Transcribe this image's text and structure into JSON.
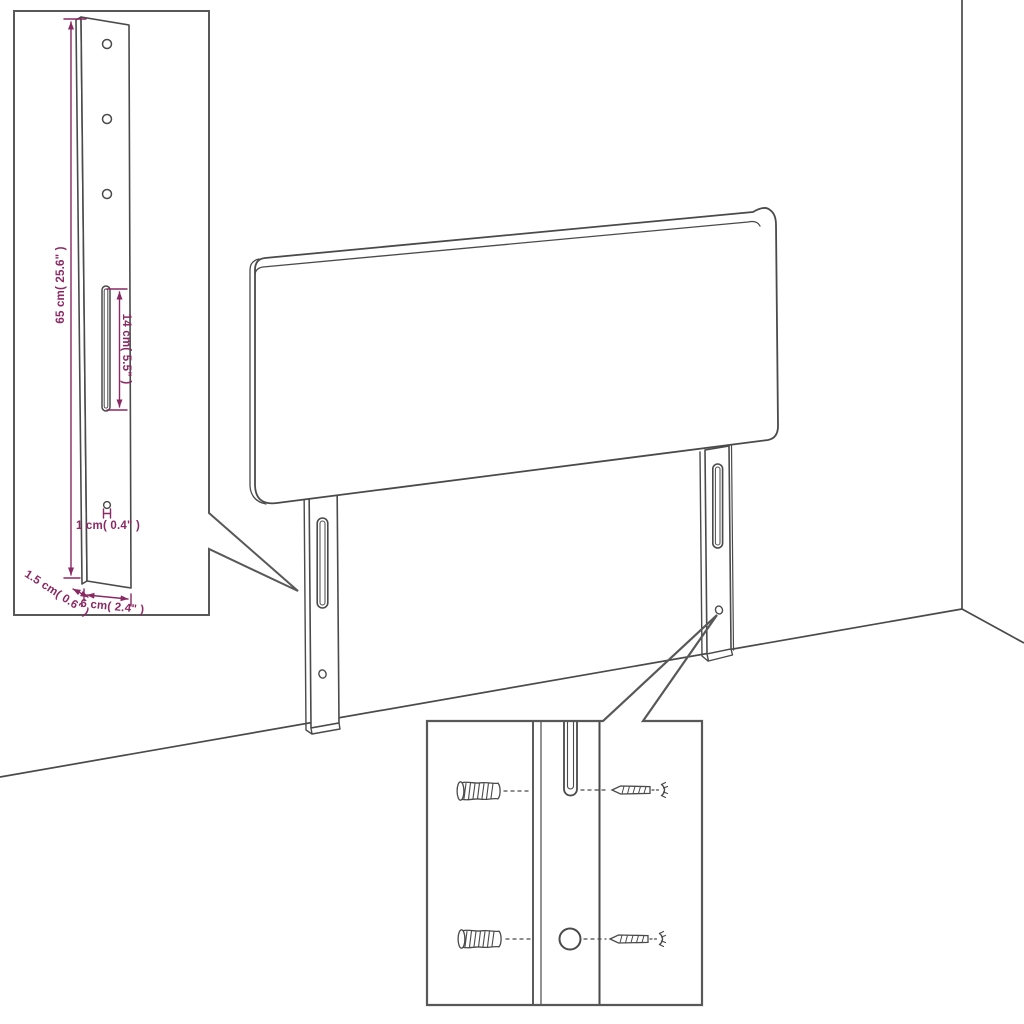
{
  "colors": {
    "background": "#ffffff",
    "line_art": "#4a4a4a",
    "callout": "#585858",
    "dimension": "#8a2963"
  },
  "detail_labels": {
    "leg_height": "65 cm( 25.6\" )",
    "slot_length": "14 cm( 5.5\" )",
    "hole_diameter": "1 cm( 0.4\" )",
    "leg_depth": "1.5 cm( 0.6\" )",
    "leg_width": "6 cm( 2.4\" )"
  }
}
